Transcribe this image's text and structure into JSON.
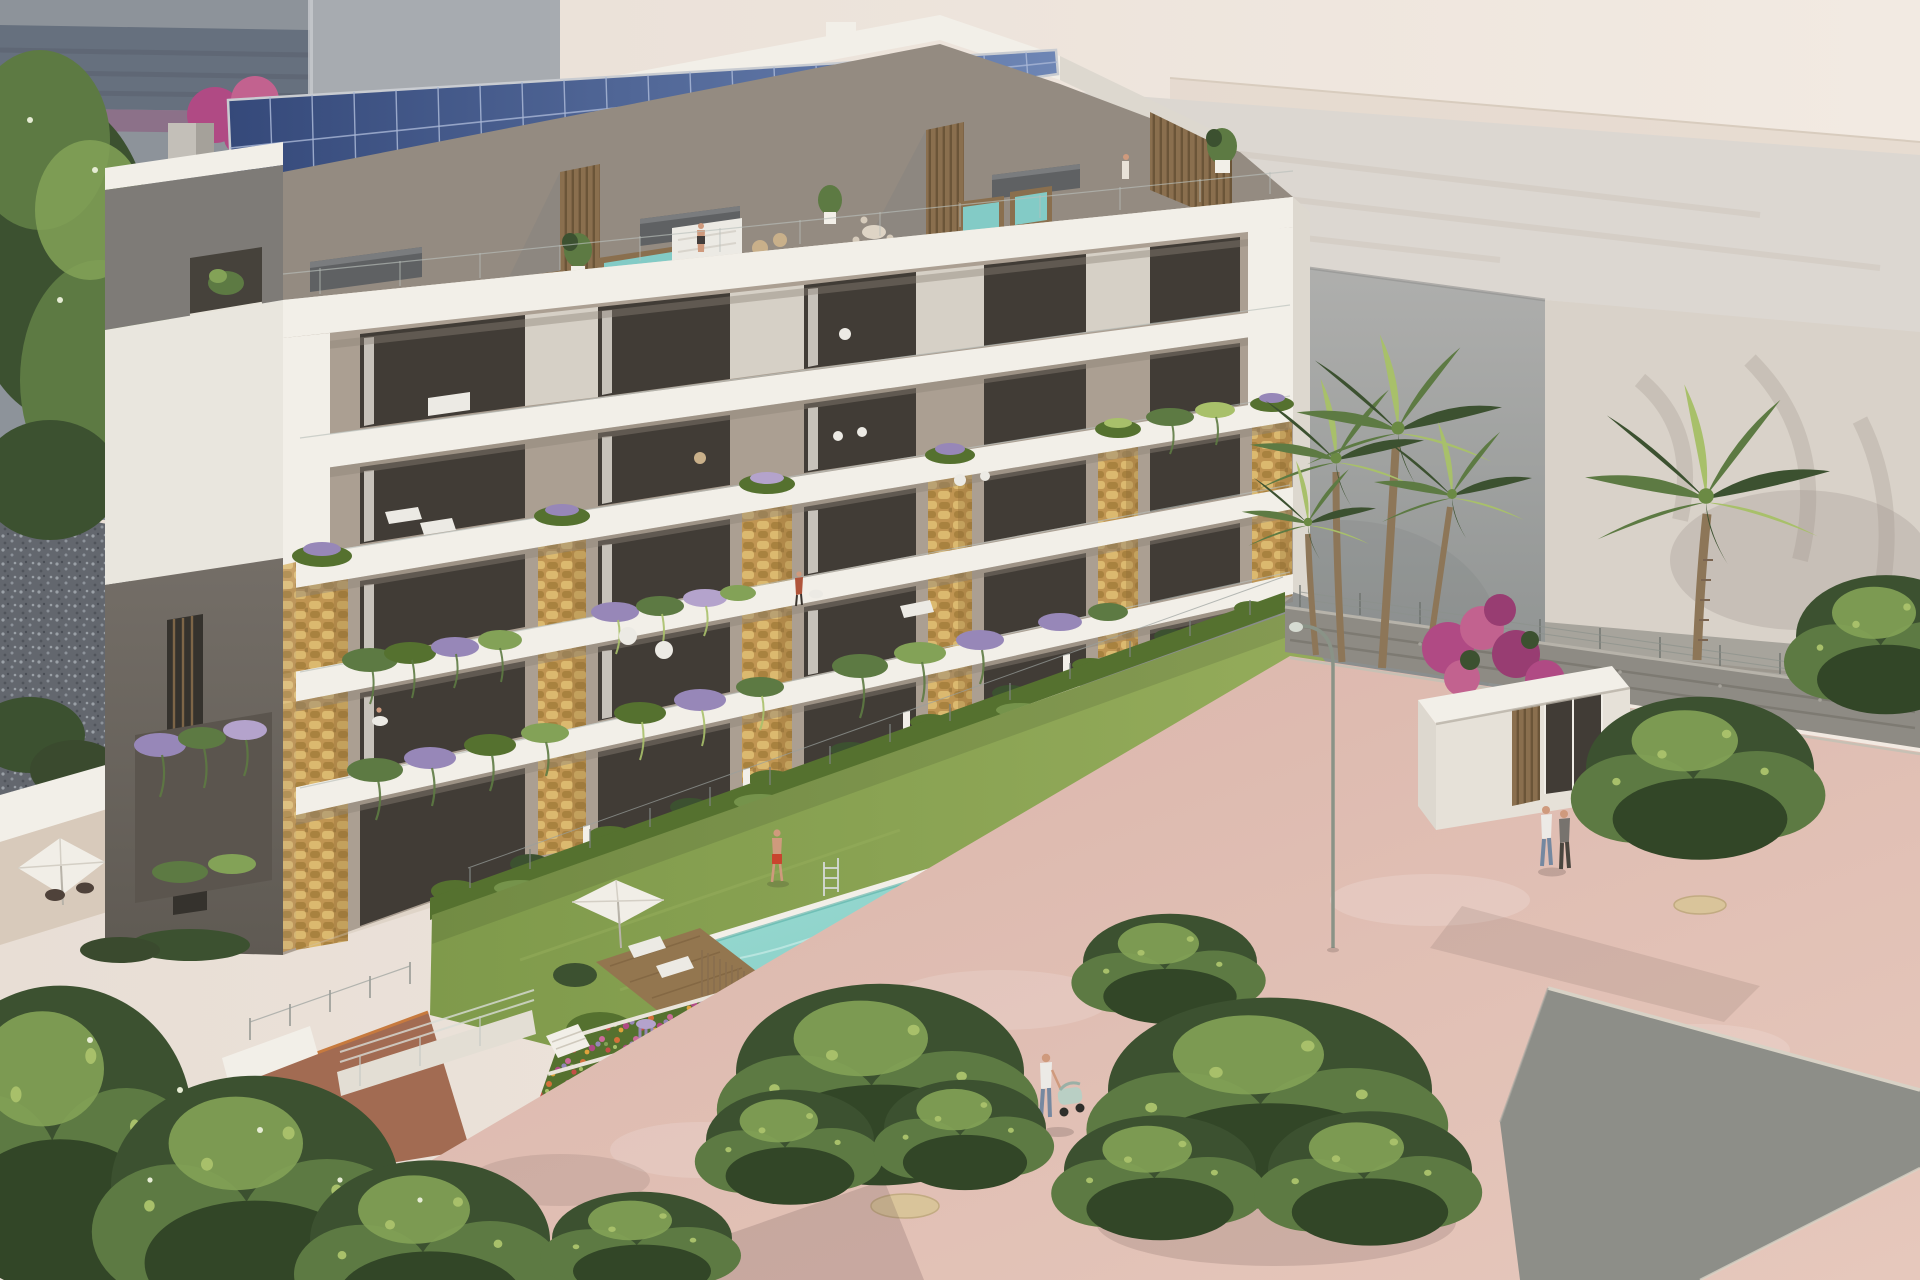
{
  "scene": {
    "type": "architectural_rendering",
    "setting": "sunlit seaside promenade, aerial three-quarter view, warm afternoon light",
    "description": "Photorealistic render of a modern six-storey apartment building with a rooftop solar-panel strip, penthouse spa terraces with hot tubs, golden dry-stone pillars, white floor slabs with planted balconies, a turquoise infinity lap pool with a swimmer, stepped flower terraces, and a rose-paved promenade with palms, street trees, curved lamp posts, bicycles and pedestrians in front of pale background buildings.",
    "elements": {
      "neighbor_building": "grey block with dark glazing band and mauve spandrel, top left",
      "left_tree": "tall dark green tree at left edge over grey gravel",
      "solar_array": "strip of tilted blue photovoltaic panels along the roof edge",
      "penthouses": "recessed roof terraces with wood-slat partitions, outdoor kitchens, dining sets, sofas and four hot tubs",
      "facade": "white horizontal slabs, glass balustrades, six golden stone pillars, dark glazed openings, cascading lavender and fern planters",
      "west_gable": "taupe side wall with slatted windows, white frame band and lavender planter",
      "ground_gardens": "private patios with box hedges, parasol, deck, reed fence and plunge pool",
      "pool": "long turquoise infinity lap pool with chrome ladder and swimmer",
      "lawn": "grass strip with man in red trunks, parasols, loungers and standing woman",
      "flower_terraces": "four stepped white-edged beds of orange, red, pink, magenta and purple planting",
      "promenade": "rose-coloured paving with sandy tree pits, gabion wall and wire fence",
      "entrance_pavilion": "white flat-roofed gate structure with glass door and reed screen",
      "bougainvillea": "magenta flowering shrub beside the gate",
      "palms": "cluster of four palms beside the building and one tall lone palm",
      "street_furniture": "two curved olive lamp posts, bicycle rack with bicycles",
      "people": "swimmer, man in red trunks, sunbather, penthouse figures, couple strolling, parent with pram",
      "background": "pale cream high-rise volumes with soft palm shadows and a shaded grey block",
      "road": "grey asphalt lane crossing the lower right corner"
    },
    "counts": {
      "visible_floor_levels": 6,
      "stone_pillars": 6,
      "hot_tubs": 4,
      "palm_trees": 5,
      "solar_panels": 22,
      "lamp_posts": 2
    }
  },
  "palette": {
    "sky-left": "#e8ded5",
    "sky-right": "#f2eae2",
    "neighbor-wall": "#8d939a",
    "neighbor-band": "#66707e",
    "neighbor-band-dark": "#59616d",
    "neighbor-mauve": "#8c7189",
    "neighbor-light": "#a7abb0",
    "bg-cream": "#ece3da",
    "bg-cream-dark": "#e2d6ca",
    "bg-marble": "#dcd7d1",
    "bg-marble-streak": "#cdc5bc",
    "gray-block-top": "#b1b1af",
    "gray-block-bottom": "#8d9190",
    "right-wall": "#d9d2c9",
    "wall-shadow": "#a9a095",
    "gravel-strip": "#a7a49c",
    "gabion": "#8e8b84",
    "gabion-dark": "#79766e",
    "white-lit": "#f2efe8",
    "white-shade": "#ddd8cf",
    "slab-shadow": "#8d8478",
    "panel-dark": "#35497a",
    "panel-light": "#6e86b5",
    "panel-frame": "#c9ccd1",
    "panel-line": "#a9b7d6",
    "penthouse-back": "#948b81",
    "gable-gray": "#7e7b77",
    "gable-taupe": "#746e67",
    "gable-taupe-dark": "#5f5a53",
    "wood": "#8a6f4e",
    "wood-dark": "#6b5538",
    "glass-dark": "#413c36",
    "curtain": "#e8e4dc",
    "interior-wall": "#ab9f92",
    "stone-base": "#c09552",
    "stone-light": "#dbb96f",
    "stone-dark": "#a8823f",
    "stone-mortar": "#8a6b34",
    "green-dark": "#3c5130",
    "green-mid": "#5d7a43",
    "green-light": "#83a257",
    "green-pale": "#a8c06a",
    "blossom": "#e6ecd4",
    "lavender": "#9787b8",
    "lavender-light": "#b4a3cc",
    "hedge": "#55712f",
    "hedge-light": "#7f9c4e",
    "grass": "#7f9a4b",
    "grass-light": "#96ad5c",
    "pool-light": "#a3ded6",
    "pool-mid": "#7ccac1",
    "pool-deep": "#58b0a6",
    "pool-sparkle": "#d9f3ee",
    "flower-orange": "#d4703a",
    "flower-red": "#c44f46",
    "flower-pink": "#cc6b9a",
    "flower-magenta": "#b04a84",
    "flower-yellow": "#e0a33c",
    "terracotta": "#a26b52",
    "terracotta-edge": "#c77a3e",
    "pavement": "#d9b3a9",
    "pavement-light": "#e6c8bc",
    "pavement-shadow": "#b08f8c",
    "road": "#8d8e88",
    "curb": "#d8d2c6",
    "trunk": "#4a4438",
    "palm-trunk": "#8d7658",
    "lamp": "#8a9387",
    "lamp-dark": "#6f7a6b",
    "skin": "#cf9a7d",
    "jeans": "#7588a0",
    "shirt-white": "#eceae6",
    "shirt-gray": "#77736e",
    "pram": "#b9cfc4",
    "red-shorts": "#c8452e",
    "umbrella": "#f1eee7",
    "furniture-white": "#eceae4",
    "tub-water": "#83cbc6",
    "sandpit": "#d9c49a",
    "fence-metal": "#9aa09c"
  }
}
